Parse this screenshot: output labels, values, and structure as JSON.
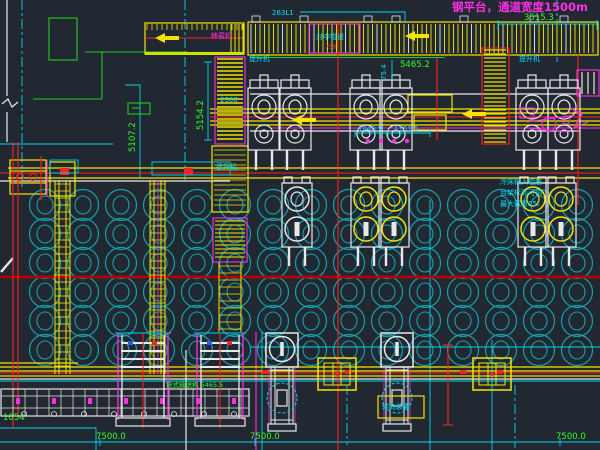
{
  "window": {
    "background": "#222831"
  },
  "texts": {
    "title": "钢平台，通道宽度1500m",
    "dim_3515": "3515.3",
    "dim_263": "263L1",
    "dim_5465": "5465.2",
    "dim_5154": "5154.2",
    "dim_754": "75.4",
    "dim_1040": "1040.9",
    "dim_1151": "1151.5",
    "dim_5107": "5107.2",
    "dim_1054": "1054",
    "dim_bottom_1": "7500.0",
    "dim_bottom_2": "7500.0",
    "dim_bottom_3": "7500.0",
    "lbl_transfer": "移载机",
    "lbl_centering": "对中辊道",
    "lbl_small_red": "750",
    "lbl_elevator_1": "提升机",
    "lbl_elevator_2": "提升机",
    "lbl_elevator_3": "提升机",
    "lbl_2300": "2300",
    "lbl_chain_conveyor": "链式输送机 5465.5",
    "note_line_1": "冷床输入辊道",
    "note_line_2": "台架标高可调",
    "note_line_3": "最大载重25t",
    "lbl_turn_unit": "转向装置"
  },
  "colors": {
    "cyan": "#00d8e8",
    "teal": "#0fa3ad",
    "yellow": "#f5e400",
    "hatch": "#ddd600",
    "hatch_alt": "#cfd8d8",
    "red": "#ff2020",
    "dark_red": "#b40000",
    "green": "#2bff2b",
    "magenta": "#ff2ee6",
    "white": "#e8e8e8"
  },
  "drawing": {
    "circle_grid": {
      "x0": 45,
      "dx": 38,
      "cols": 15,
      "rows": [
        205,
        234,
        263,
        292,
        321,
        350
      ],
      "r": 15.5,
      "rx": 8,
      "ry": 9
    },
    "mill_stands_x": [
      264,
      295,
      366,
      396,
      532,
      564
    ],
    "lower_stands": [
      {
        "cx": 297,
        "color": "#e8e8e8"
      },
      {
        "cx": 366,
        "color": "#f5e400"
      },
      {
        "cx": 394,
        "color": "#f5e400"
      },
      {
        "cx": 533,
        "color": "#f5e400"
      },
      {
        "cx": 561,
        "color": "#f5e400"
      }
    ],
    "turntables_x": [
      282,
      397
    ],
    "roller_boxes_x": [
      337,
      492
    ],
    "lift_tables": [
      {
        "x": 118,
        "w": 50
      },
      {
        "x": 197,
        "w": 46
      }
    ],
    "ladders_x": [
      55,
      150
    ],
    "red_band_marks_x": [
      262,
      345,
      460,
      497
    ],
    "top_cap_marks_x": [
      252,
      300,
      364,
      392,
      460,
      530,
      560
    ],
    "wheel_dots_x": [
      368,
      381,
      394,
      407
    ]
  }
}
